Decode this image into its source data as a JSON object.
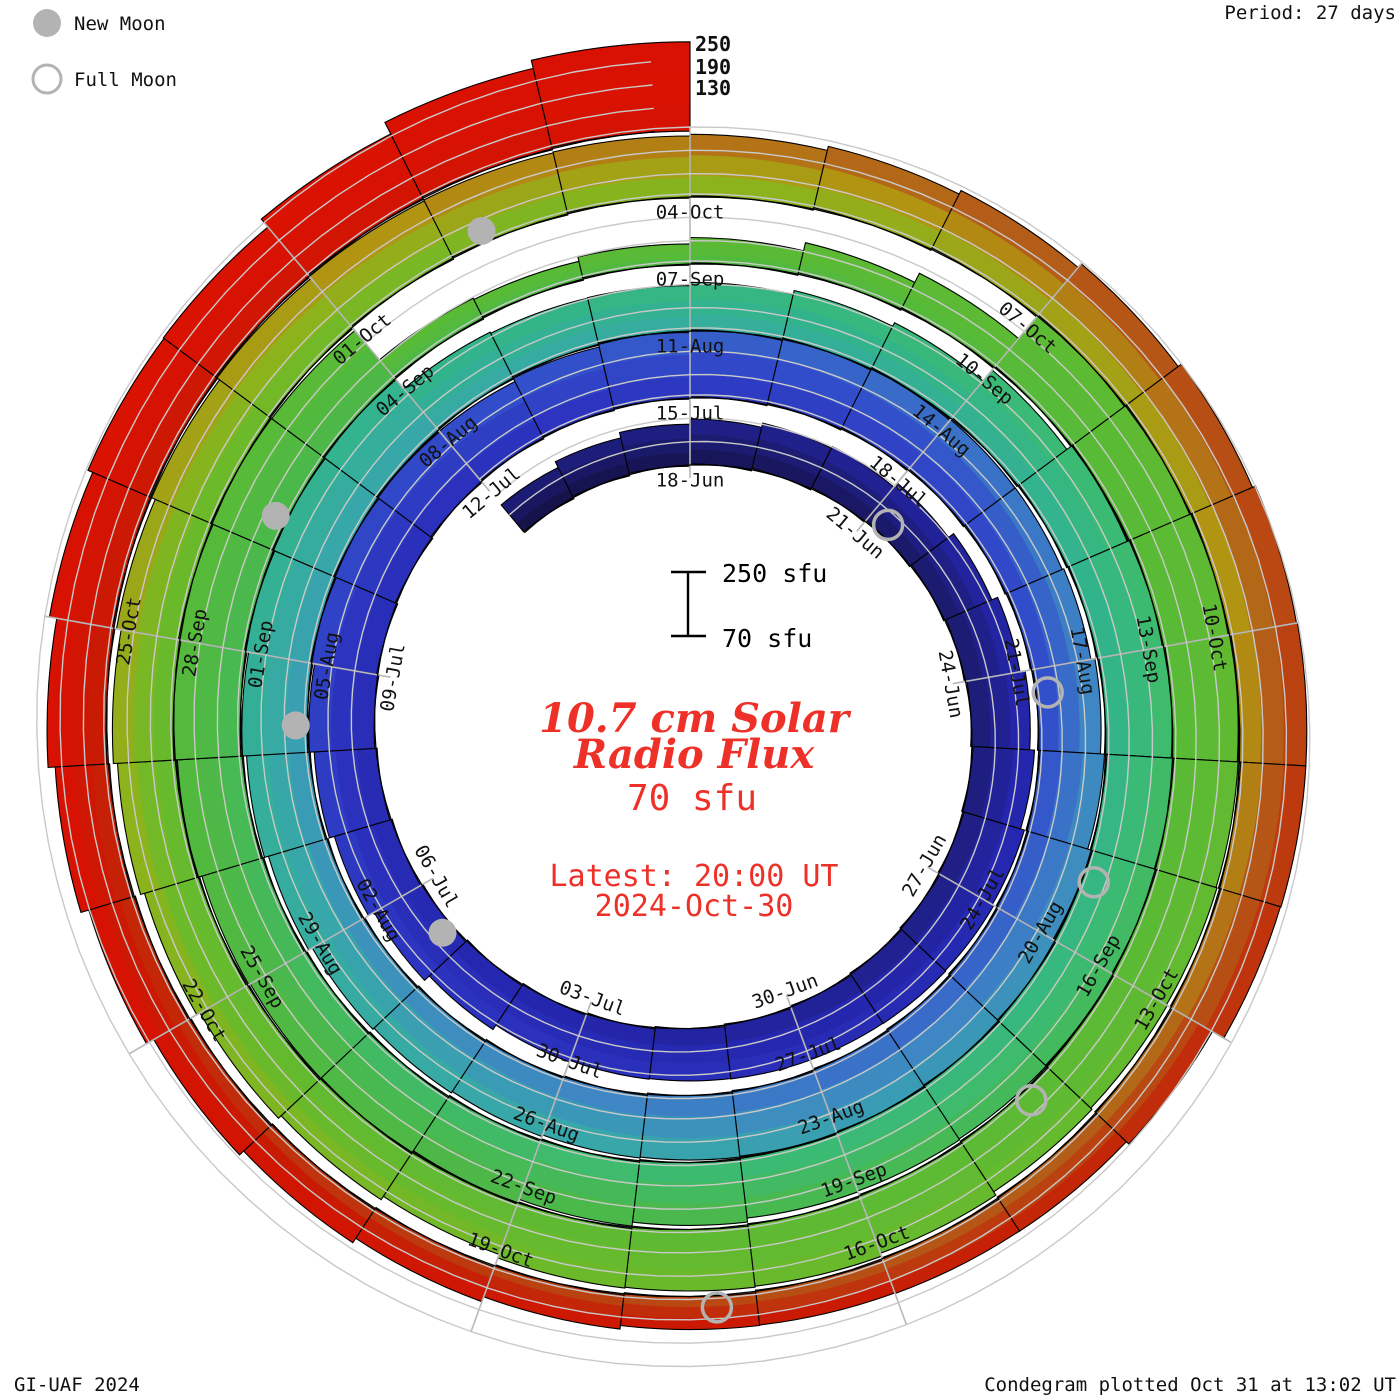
{
  "legend": {
    "new_moon_label": "New Moon",
    "full_moon_label": "Full Moon",
    "moon_color": "#b3b3b3"
  },
  "header": {
    "period_label": "Period: 27 days"
  },
  "footer": {
    "credit": "GI-UAF 2024",
    "plotted": "Condegram plotted Oct 31 at 13:02 UT"
  },
  "center": {
    "title_line1": "10.7 cm Solar",
    "title_line2": "Radio Flux",
    "current_value": "70 sfu",
    "latest_line1": "Latest: 20:00 UT",
    "latest_line2": "2024-Oct-30",
    "accent_color": "#ee3128"
  },
  "scalebar": {
    "top_label": "250 sfu",
    "bottom_label": "70 sfu"
  },
  "radial_scale_labels": {
    "l250": "250",
    "l190": "190",
    "l130": "130"
  },
  "chart_data": {
    "type": "bar",
    "subtype": "spiral-condegram",
    "title": "10.7 cm Solar Radio Flux",
    "period_days": 27,
    "baseline_sfu": 70,
    "gridlines_sfu": [
      130,
      190,
      250
    ],
    "start_date": "2024-06-15",
    "end_date": "2024-10-30",
    "flux_daily_sfu": [
      160,
      170,
      178,
      185,
      190,
      188,
      195,
      205,
      215,
      222,
      228,
      232,
      230,
      225,
      218,
      212,
      205,
      200,
      198,
      205,
      215,
      225,
      232,
      238,
      242,
      245,
      240,
      235,
      238,
      242,
      248,
      246,
      240,
      236,
      230,
      228,
      232,
      236,
      240,
      244,
      248,
      245,
      240,
      236,
      232,
      230,
      228,
      226,
      230,
      234,
      238,
      242,
      246,
      248,
      205,
      195,
      190,
      192,
      196,
      200,
      230,
      240,
      248,
      250,
      248,
      244,
      240,
      236,
      232,
      228,
      232,
      236,
      240,
      242,
      238,
      236,
      240,
      244,
      246,
      242,
      235,
      130,
      120,
      125,
      135,
      150,
      170,
      245,
      248,
      246,
      240,
      236,
      232,
      228,
      226,
      230,
      232,
      228,
      224,
      208,
      212,
      215,
      218,
      222,
      226,
      232,
      236,
      238,
      238,
      234,
      230,
      228,
      232,
      236,
      242,
      246,
      248,
      244,
      238,
      230,
      190,
      175,
      168,
      160,
      155,
      158,
      165,
      172,
      180,
      195,
      210,
      222,
      235,
      242,
      238,
      258,
      285,
      300
    ],
    "tick_labels": [
      "18-Jun",
      "21-Jun",
      "24-Jun",
      "27-Jun",
      "30-Jun",
      "03-Jul",
      "06-Jul",
      "09-Jul",
      "12-Jul",
      "15-Jul",
      "18-Jul",
      "21-Jul",
      "24-Jul",
      "27-Jul",
      "30-Jul",
      "02-Aug",
      "05-Aug",
      "08-Aug",
      "11-Aug",
      "14-Aug",
      "17-Aug",
      "20-Aug",
      "23-Aug",
      "26-Aug",
      "29-Aug",
      "01-Sep",
      "04-Sep",
      "07-Sep",
      "10-Sep",
      "13-Sep",
      "16-Sep",
      "19-Sep",
      "22-Sep",
      "25-Sep",
      "28-Sep",
      "01-Oct",
      "04-Oct",
      "07-Oct",
      "10-Oct",
      "13-Oct",
      "16-Oct",
      "19-Oct",
      "22-Oct",
      "25-Oct"
    ],
    "new_moons": [
      "2024-07-05",
      "2024-08-04",
      "2024-09-02",
      "2024-10-02"
    ],
    "full_moons": [
      "2024-06-21",
      "2024-07-21",
      "2024-08-19",
      "2024-09-17",
      "2024-10-17"
    ],
    "colormap": [
      [
        0,
        "#141040"
      ],
      [
        10,
        "#1c1c74"
      ],
      [
        20,
        "#2526ae"
      ],
      [
        30,
        "#2c34c0"
      ],
      [
        38,
        "#3350cb"
      ],
      [
        46,
        "#3e86c4"
      ],
      [
        54,
        "#38a7aa"
      ],
      [
        64,
        "#32b48b"
      ],
      [
        72,
        "#3cbb70"
      ],
      [
        80,
        "#4ab84c"
      ],
      [
        90,
        "#58ba36"
      ],
      [
        100,
        "#5fba32"
      ],
      [
        108,
        "#6cb92a"
      ],
      [
        113,
        "#8db31c"
      ],
      [
        118,
        "#b19512"
      ],
      [
        123,
        "#b45d18"
      ],
      [
        128,
        "#bc3a0e"
      ],
      [
        133,
        "#c91a04"
      ],
      [
        140,
        "#d81202"
      ],
      [
        175,
        "#de0f00"
      ]
    ],
    "grid_color": "#c9c9c9",
    "radial_grid_color": "#b8b8b8",
    "baseline_color": "#000000",
    "legend_position": "top-left"
  }
}
